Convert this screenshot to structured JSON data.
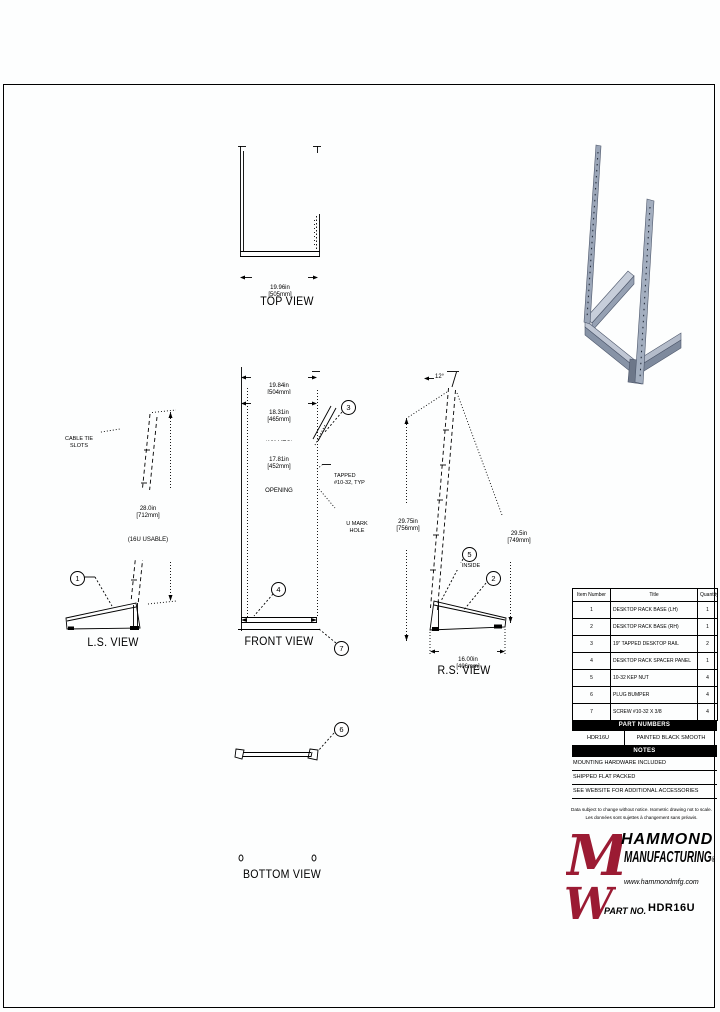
{
  "views": {
    "top": {
      "label": "TOP VIEW",
      "dim_in": "19.96in",
      "dim_mm": "[505mm]"
    },
    "front": {
      "label": "FRONT VIEW",
      "overall_in": "19.84in",
      "overall_mm": "[504mm]",
      "mtg_in": "18.31in",
      "mtg_mm": "[465mm]",
      "mtg_note": "(19\" MTG)",
      "open_in": "17.81in",
      "open_mm": "[452mm]",
      "open_note": "OPENING",
      "tapped_1": "TAPPED",
      "tapped_2": "#10-32, TYP",
      "umark_1": "U MARK",
      "umark_2": "HOLE"
    },
    "ls": {
      "label": "L.S. VIEW",
      "cable_1": "CABLE TIE",
      "cable_2": "SLOTS",
      "usable_in": "28.0in",
      "usable_mm": "[712mm]",
      "usable_note": "(16U USABLE)"
    },
    "rs": {
      "label": "R.S. VIEW",
      "angle": "12°",
      "rail_in": "29.75in",
      "rail_mm": "[756mm]",
      "height_in": "29.5in",
      "height_mm": "[749mm]",
      "depth_in": "16.00in",
      "depth_mm": "[406mm]",
      "inside": "INSIDE"
    },
    "bottom": {
      "label": "BOTTOM VIEW"
    }
  },
  "balloons": {
    "b1": "1",
    "b2": "2",
    "b3": "3",
    "b4": "4",
    "b5": "5",
    "b6": "6",
    "b7": "7"
  },
  "parts_table": {
    "headers": {
      "item": "Item Number",
      "title": "Title",
      "qty": "Quantity"
    },
    "rows": [
      {
        "item": "1",
        "title": "DESKTOP RACK BASE (LH)",
        "qty": "1"
      },
      {
        "item": "2",
        "title": "DESKTOP RACK BASE (RH)",
        "qty": "1"
      },
      {
        "item": "3",
        "title": "19\" TAPPED DESKTOP RAIL",
        "qty": "2"
      },
      {
        "item": "4",
        "title": "DESKTOP RACK SPACER PANEL",
        "qty": "1"
      },
      {
        "item": "5",
        "title": "10-32 KEP NUT",
        "qty": "4"
      },
      {
        "item": "6",
        "title": "PLUG BUMPER",
        "qty": "4"
      },
      {
        "item": "7",
        "title": "SCREW #10-32 X 3/8",
        "qty": "4"
      }
    ]
  },
  "part_numbers": {
    "banner": "PART NUMBERS",
    "number": "HDR16U",
    "finish": "PAINTED BLACK SMOOTH"
  },
  "notes": {
    "banner": "NOTES",
    "items": [
      "MOUNTING HARDWARE INCLUDED",
      "SHIPPED FLAT PACKED",
      "SEE WEBSITE FOR ADDITIONAL ACCESSORIES"
    ]
  },
  "disclaimer": {
    "line1": "Data subject to change without notice. Isometric drawing not to scale.",
    "line2": "Les données sont sujettes à changement sans préavis."
  },
  "brand": {
    "name_line1": "HAMMOND",
    "name_line2": "MANUFACTURING",
    "reg": "®",
    "website": "www.hammondmfg.com",
    "logo_letter_m": "M",
    "logo_letter_w": "W"
  },
  "part_no": {
    "label": "PART NO.",
    "value": "HDR16U"
  },
  "colors": {
    "brand_maroon": "#9b1b33",
    "line": "#000000",
    "iso_steel": "#9ba6b8"
  }
}
